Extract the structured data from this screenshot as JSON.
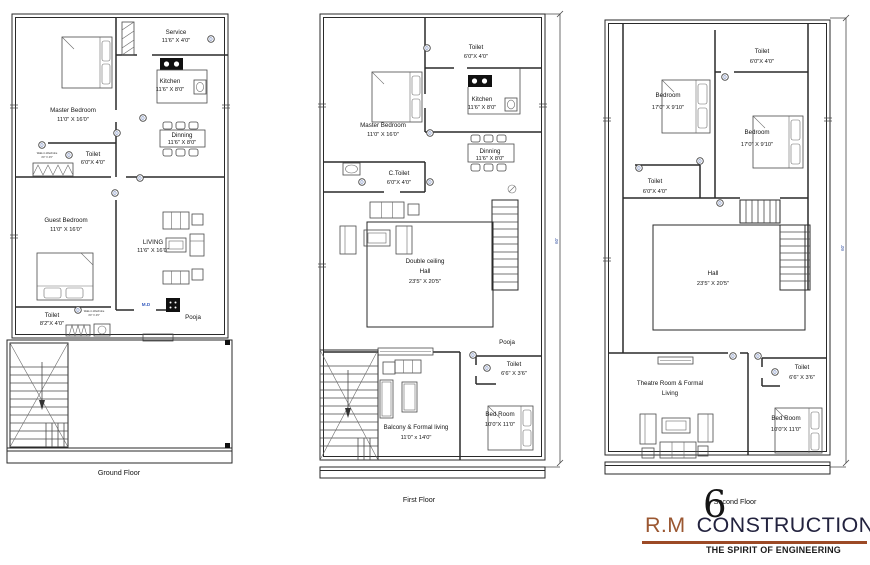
{
  "ground": {
    "title": "Ground Floor",
    "rooms": {
      "master": {
        "name": "Master Bedroom",
        "dim": "11'0\" X 16'0\""
      },
      "service": {
        "name": "Service",
        "dim": "11'6\" X 4'0\""
      },
      "kitchen": {
        "name": "Kitchen",
        "dim": "11'6\" X 8'0\""
      },
      "dinning": {
        "name": "Dinning",
        "dim": "11'6\" X 8'0\""
      },
      "toilet_mid": {
        "name": "Toilet",
        "dim": "6'0\"X 4'0\""
      },
      "guest": {
        "name": "Guest  Bedroom",
        "dim": "11'0\" X 16'0\""
      },
      "living": {
        "name": "LIVING",
        "dim": "11'6\" X 16'0\""
      },
      "toilet_bottom": {
        "name": "Toilet",
        "dim": "8'2\"X 4'0\""
      },
      "pooja": {
        "name": "Pooja"
      },
      "main_door": {
        "name": "M.D"
      }
    }
  },
  "first": {
    "title": "First Floor",
    "dim_side": "60'",
    "rooms": {
      "toilet_top": {
        "name": "Toilet",
        "dim": "6'0\"X 4'0\""
      },
      "kitchen": {
        "name": "Kitchen",
        "dim": "11'6\" X 8'0\""
      },
      "master": {
        "name": "Master Bedroom",
        "dim": "11'0\" X 16'0\""
      },
      "c_toilet": {
        "name": "C.Toilet",
        "dim": "6'0\"X 4'0\""
      },
      "dinning": {
        "name": "Dinning",
        "dim": "11'6\" X 8'0\""
      },
      "hall": {
        "line1": "Double ceiling",
        "line2": "Hall",
        "dim": "23'5\" X 20'5\""
      },
      "pooja": {
        "name": "Pooja"
      },
      "toilet_br": {
        "name": "Toilet",
        "dim": "6'6\" X 3'6\""
      },
      "bedroom": {
        "name": "Bed Room",
        "dim": "10'0\"X 11'0\""
      },
      "balcony": {
        "name": "Balcony & Formal living",
        "dim": "11'0\" x 14'0\""
      }
    }
  },
  "second": {
    "title": "Second Floor",
    "dim_side": "60'",
    "rooms": {
      "toilet_top": {
        "name": "Toilet",
        "dim": "6'0\"X 4'0\""
      },
      "bedroom_left": {
        "name": "Bedroom",
        "dim": "17'0\" X 9'10\""
      },
      "bedroom_right": {
        "name": "Bedroom",
        "dim": "17'0\" X 9'10\""
      },
      "toilet_left": {
        "name": "Toilet",
        "dim": "6'0\"X 4'0\""
      },
      "hall": {
        "name": "Hall",
        "dim": "23'5\" X 20'5\""
      },
      "theatre": {
        "line1": "Theatre Room & Formal",
        "line2": "Living"
      },
      "toilet_br": {
        "name": "Toilet",
        "dim": "6'6\" X 3'6\""
      },
      "bedroom_br": {
        "name": "Bed Room",
        "dim": "10'0\"X 11'0\""
      }
    }
  },
  "notes": {
    "line1": "Walk-in Wardrobe",
    "line2": "4'0\" X 4'0\""
  },
  "markers": {
    "door": "D"
  },
  "logo": {
    "brand_left": "R.M",
    "brand_right": "CONSTRUCTION",
    "swoosh": "6",
    "tagline": "THE SPIRIT OF ENGINEERING",
    "accent_color": "#9b5731",
    "text_color": "#23233f",
    "underline_color": "#9c4a26"
  }
}
